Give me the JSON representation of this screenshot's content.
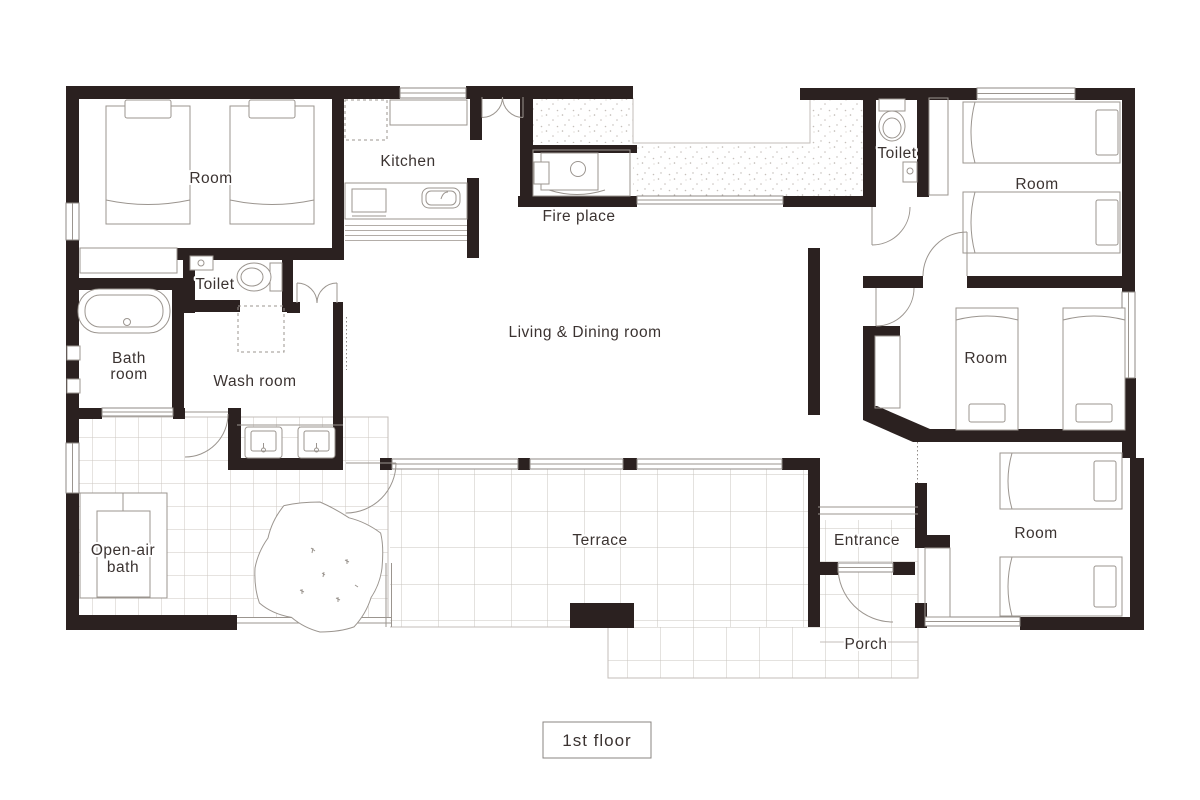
{
  "title": {
    "floor_label": "1st floor"
  },
  "rooms": {
    "room_top_left": "Room",
    "kitchen": "Kitchen",
    "fire_place": "Fire place",
    "toilet_left": "Toilet",
    "toilet_right": "Toilet",
    "room_top_right": "Room",
    "living_dining": "Living & Dining room",
    "bath_room_line1": "Bath",
    "bath_room_line2": "room",
    "wash_room": "Wash room",
    "open_air_bath_line1": "Open-air",
    "open_air_bath_line2": "bath",
    "room_mid_right": "Room",
    "terrace": "Terrace",
    "entrance": "Entrance",
    "porch": "Porch",
    "room_bottom_right": "Room"
  },
  "colors": {
    "wall": "#2b2120",
    "furniture_line": "#9b958f",
    "grid_line": "#ccc7c2",
    "text": "#3b3331",
    "background": "#ffffff"
  }
}
